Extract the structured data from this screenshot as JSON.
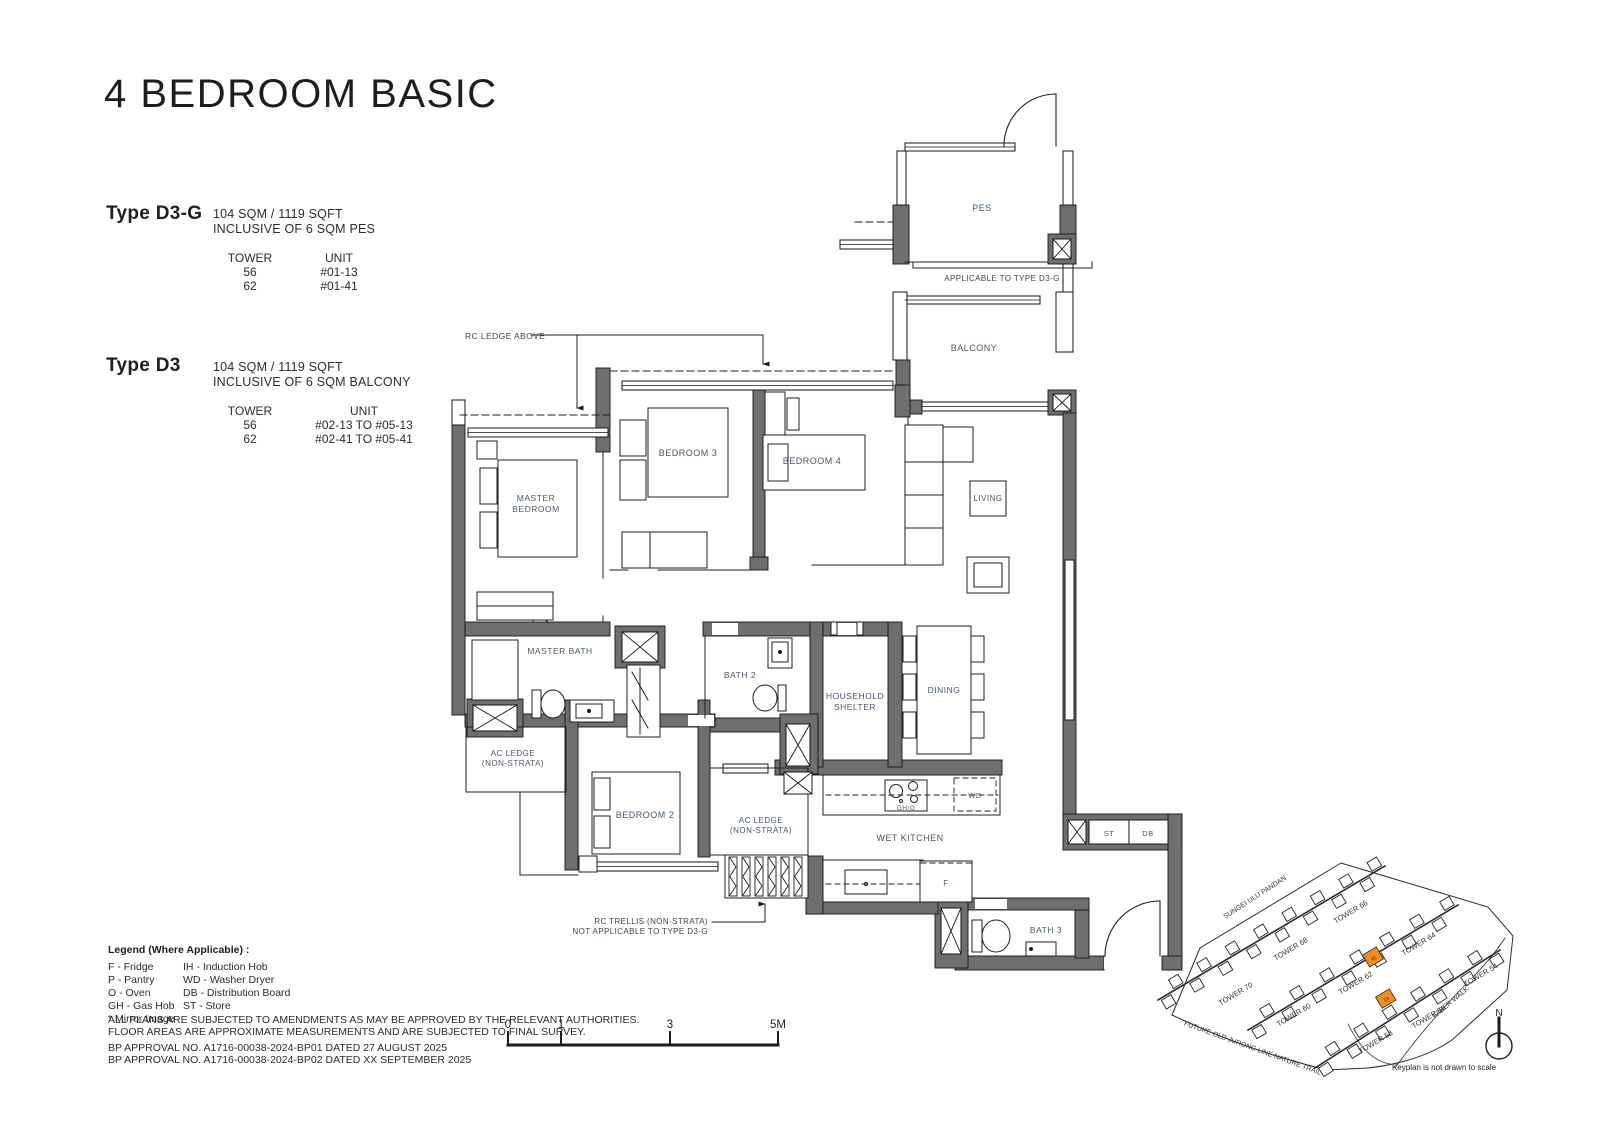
{
  "page": {
    "title": "4 BEDROOM BASIC"
  },
  "types": [
    {
      "name": "Type D3-G",
      "area": "104 SQM / 1119 SQFT",
      "inclusive": "INCLUSIVE OF 6 SQM PES",
      "tower_header": "TOWER",
      "unit_header": "UNIT",
      "rows": [
        {
          "tower": "56",
          "unit": "#01-13"
        },
        {
          "tower": "62",
          "unit": "#01-41"
        }
      ]
    },
    {
      "name": "Type D3",
      "area": "104 SQM / 1119 SQFT",
      "inclusive": "INCLUSIVE OF 6 SQM BALCONY",
      "tower_header": "TOWER",
      "unit_header": "UNIT",
      "rows": [
        {
          "tower": "56",
          "unit": "#02-13 TO #05-13"
        },
        {
          "tower": "62",
          "unit": "#02-41 TO #05-41"
        }
      ]
    }
  ],
  "legend": {
    "title": "Legend (Where Applicable) :",
    "col1": [
      "F - Fridge",
      "P - Pantry",
      "O - Oven",
      "GH - Gas Hob",
      "* Mirror Image"
    ],
    "col2": [
      "IH - Induction Hob",
      "WD - Washer Dryer",
      "DB - Distribution Board",
      "ST - Store"
    ]
  },
  "disclaimer": [
    "ALL PLANS ARE SUBJECTED TO AMENDMENTS AS MAY BE APPROVED BY THE RELEVANT AUTHORITIES.",
    "FLOOR AREAS ARE APPROXIMATE MEASUREMENTS AND ARE SUBJECTED TO FINAL SURVEY."
  ],
  "approvals": [
    "BP APPROVAL NO. A1716-00038-2024-BP01  DATED 27 AUGUST 2025",
    "BP APPROVAL NO. A1716-00038-2024-BP02  DATED XX SEPTEMBER 2025"
  ],
  "plan": {
    "rooms": {
      "pes": "PES",
      "balcony": "BALCONY",
      "bedroom3": "BEDROOM 3",
      "bedroom4": "BEDROOM 4",
      "living": "LIVING",
      "master_bedroom_1": "MASTER",
      "master_bedroom_2": "BEDROOM",
      "master_bath": "MASTER BATH",
      "bath2": "BATH 2",
      "household_1": "HOUSEHOLD",
      "household_2": "SHELTER",
      "dining": "DINING",
      "ac_ledge_1a": "AC LEDGE",
      "ac_ledge_1b": "(NON-STRATA)",
      "bedroom2": "BEDROOM 2",
      "ac_ledge_2a": "AC LEDGE",
      "ac_ledge_2b": "(NON-STRATA)",
      "wet_kitchen": "WET KITCHEN",
      "bath3": "BATH 3",
      "st": "ST",
      "db": "DB",
      "wd": "WD",
      "f": "F",
      "gh_o": "GH/O"
    },
    "annotations": {
      "rc_ledge": "RC LEDGE ABOVE",
      "applicable": "APPLICABLE TO TYPE D3-G",
      "rc_trellis_1": "RC TRELLIS (NON-STRATA)",
      "rc_trellis_2": "NOT APPLICABLE TO TYPE D3-G"
    },
    "scale": {
      "t0": "0",
      "t1": "1",
      "t3": "3",
      "t5": "5M"
    }
  },
  "keyplan": {
    "roads": {
      "sungei": "SUNGEI ULU PANDAN",
      "jurong": "FUTURE OLD JURONG LINE NATURE TRAIL",
      "faber": "FABER WALK"
    },
    "towers": {
      "t70": "TOWER 70",
      "t68": "TOWER 68",
      "t66": "TOWER 66",
      "t60": "TOWER 60",
      "t62": "TOWER 62",
      "t64": "TOWER 64",
      "t58": "TOWER 58",
      "t56": "TOWER 56",
      "t54": "TOWER 54"
    },
    "highlight_units": [
      "41",
      "13"
    ],
    "highlight_color": "#F68B1F",
    "north": "N",
    "caption": "Keyplan is not drawn to scale"
  }
}
